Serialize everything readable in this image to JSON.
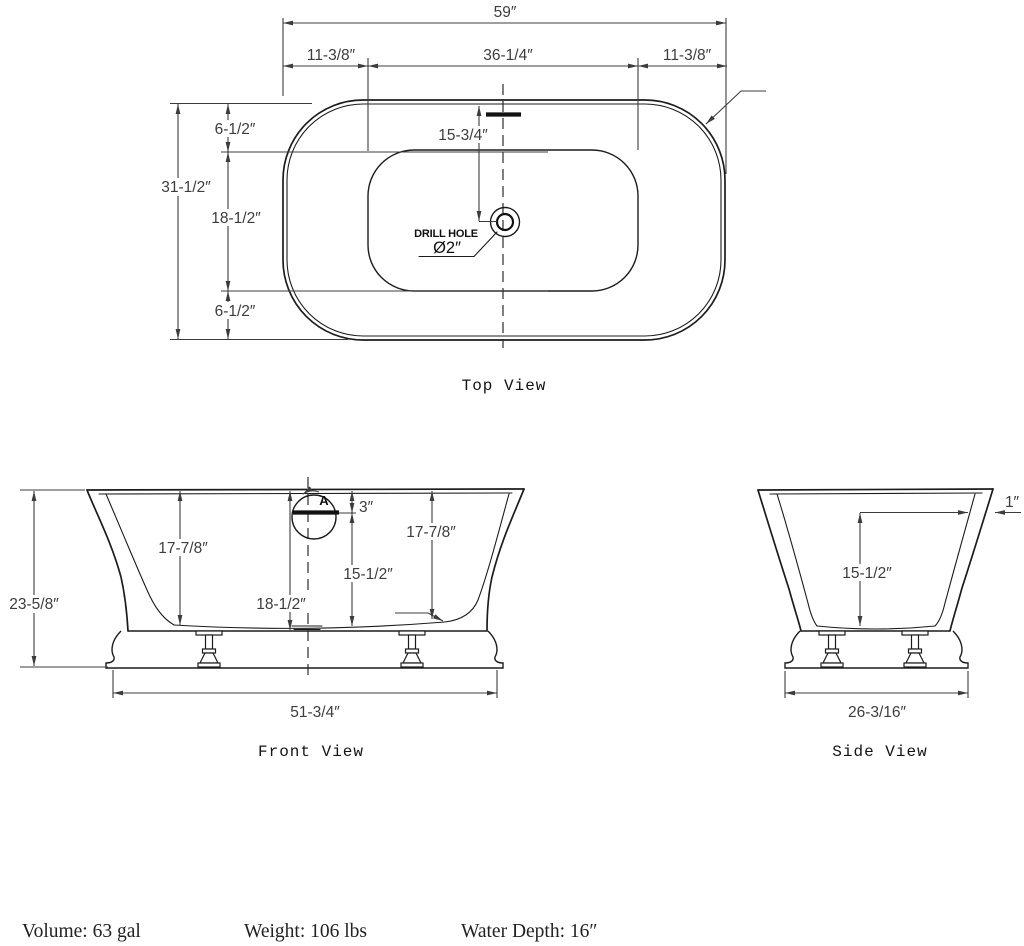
{
  "drawing": {
    "line_color": "#1c1c1c",
    "dim_color": "#3c3c3c",
    "background": "#ffffff"
  },
  "top_view": {
    "caption": "Top View",
    "dim_overall_length": "59″",
    "dim_deck_left": "11-3/8″",
    "dim_basin_length": "36-1/4″",
    "dim_deck_right": "11-3/8″",
    "dim_overall_width": "31-1/2″",
    "dim_deck_top": "6-1/2″",
    "dim_basin_width": "18-1/2″",
    "dim_deck_bottom": "6-1/2″",
    "dim_drain_offset": "15-3/4″",
    "drill_hole_label": "DRILL HOLE",
    "drill_hole_size": "Ø2″"
  },
  "front_view": {
    "caption": "Front View",
    "dim_overall_height": "23-5/8″",
    "dim_rim_to_bottom_left": "17-7/8″",
    "dim_rim_to_bottom_right": "17-7/8″",
    "dim_interior_depth_total": "18-1/2″",
    "dim_overflow_to_bottom": "15-1/2″",
    "dim_rim_to_overflow": "3″",
    "detail_marker": "A",
    "dim_base_length": "51-3/4″"
  },
  "side_view": {
    "caption": "Side View",
    "dim_rim_thickness": "1″",
    "dim_interior_depth": "15-1/2″",
    "dim_base_width": "26-3/16″"
  },
  "footer": {
    "volume": "Volume: 63 gal",
    "weight": "Weight: 106 lbs",
    "water_depth": "Water Depth: 16″"
  }
}
